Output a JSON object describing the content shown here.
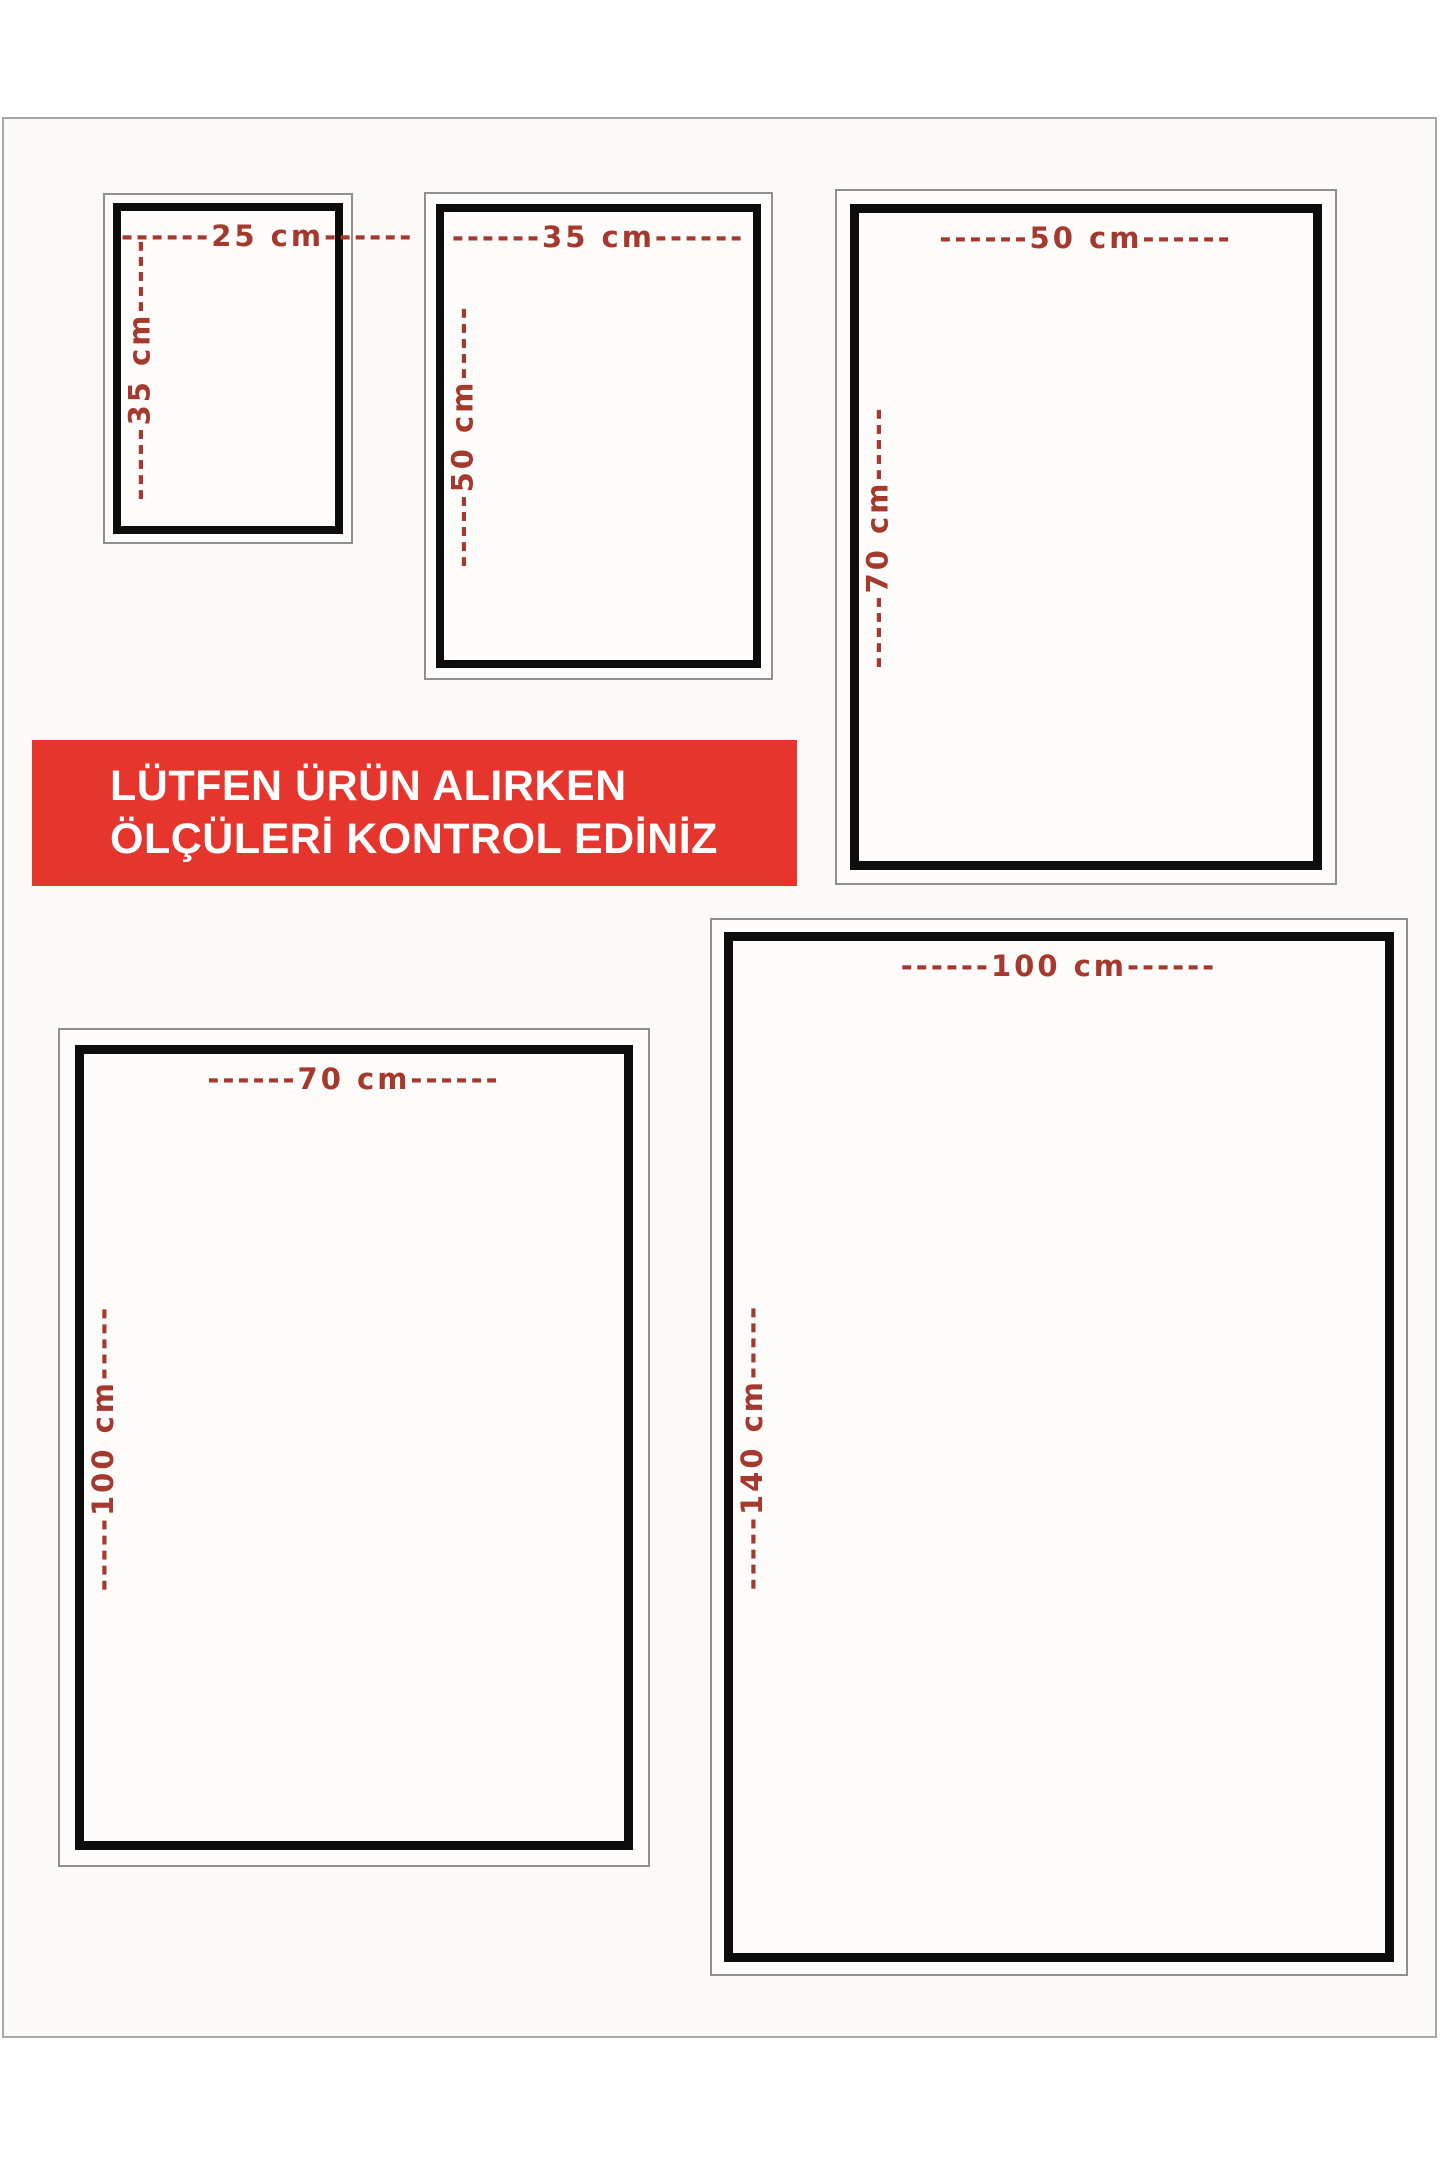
{
  "page": {
    "background": "#ffffff",
    "frame_border_color": "#a9a7a3",
    "frame_fill": "#fbfaf8"
  },
  "colors": {
    "label_red": "#a5392d",
    "frame_black": "#0d0d0d",
    "frame_gray": "#8f8f8f",
    "banner_red": "#e5352c",
    "banner_text": "#ffffff"
  },
  "banner": {
    "line1": "LÜTFEN ÜRÜN ALIRKEN",
    "line2": "ÖLÇÜLERİ KONTROL EDİNİZ"
  },
  "sizes": [
    {
      "name": "25x35 cm",
      "width_cm": 25,
      "height_cm": 35,
      "top_label": "------25 cm------",
      "side_label": "-----35 cm-----"
    },
    {
      "name": "35x50 cm",
      "width_cm": 35,
      "height_cm": 50,
      "top_label": "------35 cm------",
      "side_label": "-----50 cm-----"
    },
    {
      "name": "50x70 cm",
      "width_cm": 50,
      "height_cm": 70,
      "top_label": "------50 cm------",
      "side_label": "-----70 cm-----"
    },
    {
      "name": "70x100 cm",
      "width_cm": 70,
      "height_cm": 100,
      "top_label": "------70 cm------",
      "side_label": "-----100 cm-----"
    },
    {
      "name": "100x140 cm",
      "width_cm": 100,
      "height_cm": 140,
      "top_label": "------100 cm------",
      "side_label": "-----140 cm-----"
    }
  ]
}
